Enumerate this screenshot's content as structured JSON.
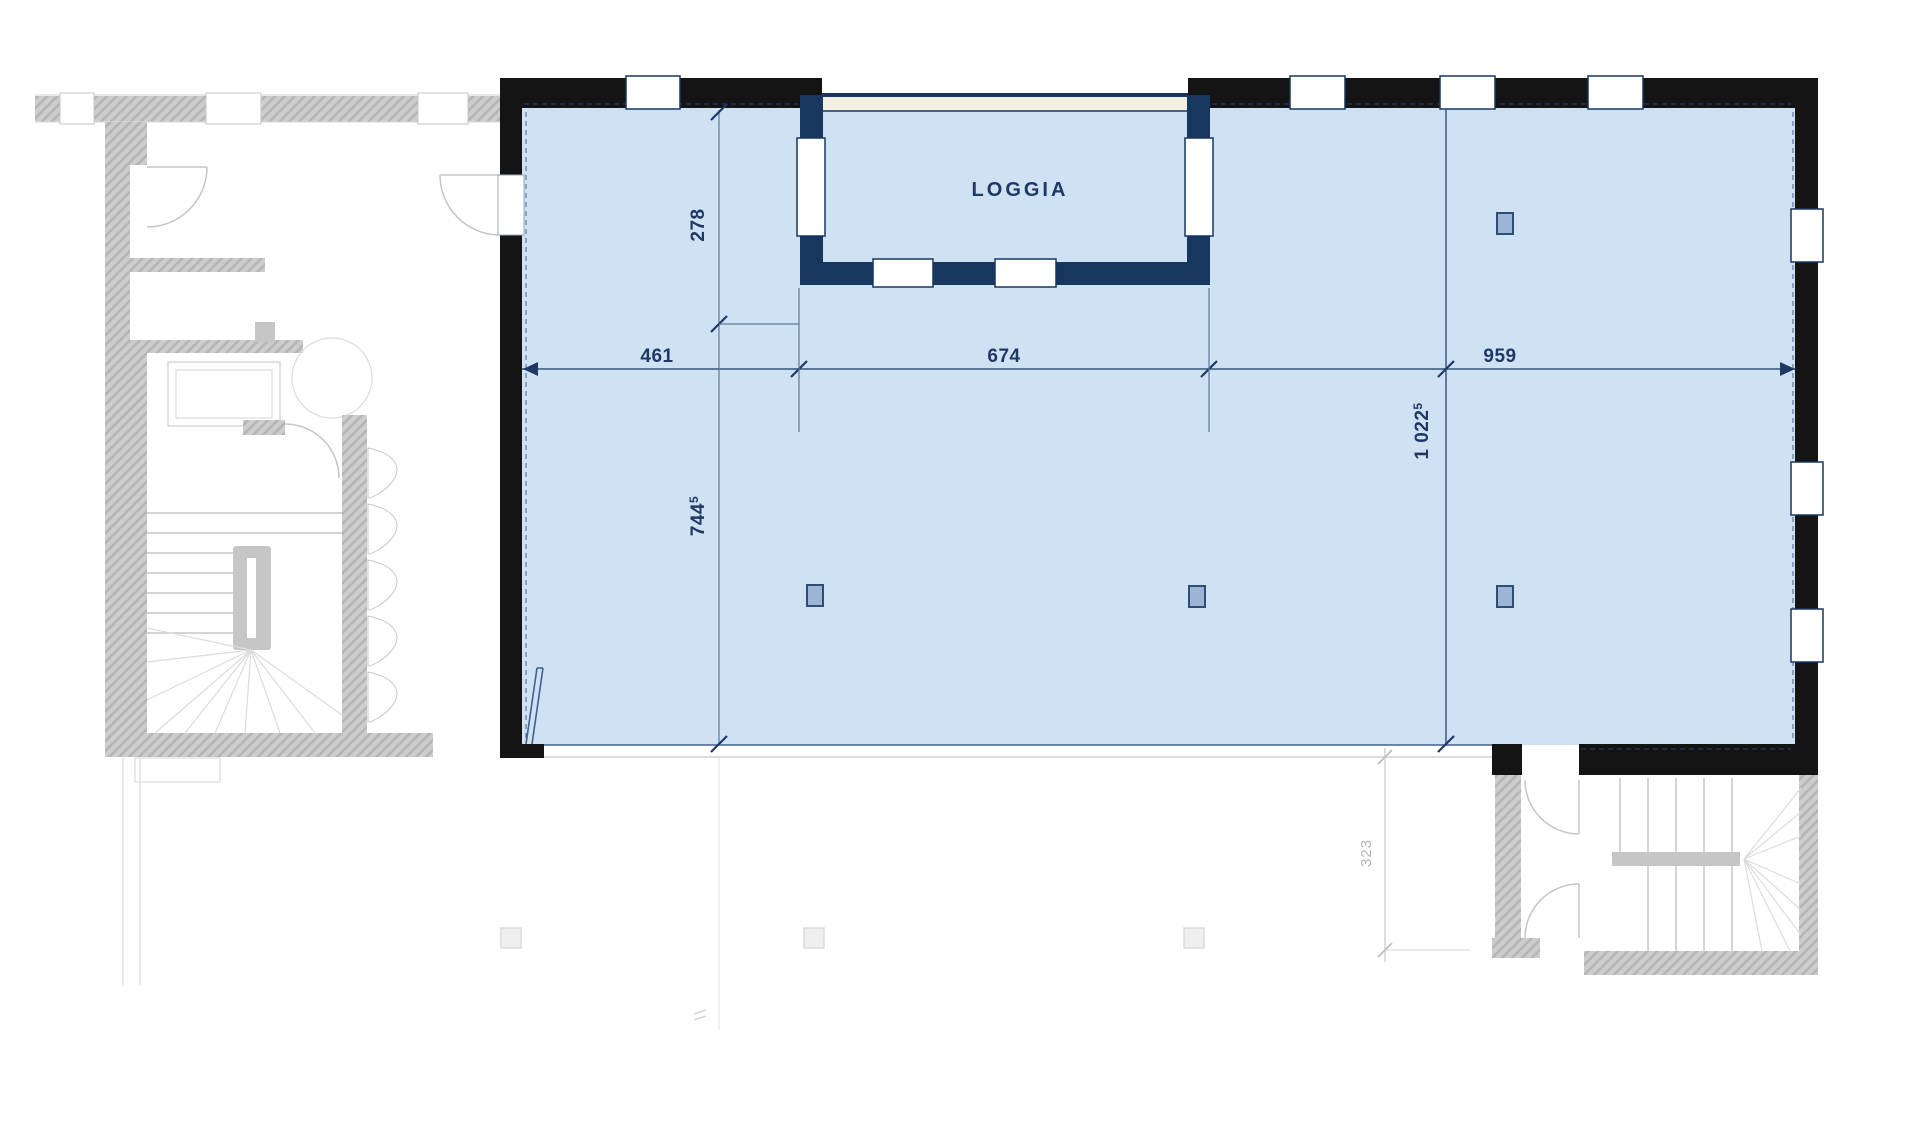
{
  "plan": {
    "room_label": "LOGGIA",
    "dimensions": {
      "d461": "461",
      "d674": "674",
      "d959": "959",
      "d278": "278",
      "d744": "744",
      "d744_sup": "5",
      "d1022": "1 022",
      "d1022_sup": "5",
      "d323": "323"
    }
  },
  "colors": {
    "room-fill": "#cfe2f4",
    "wall-black": "#141414",
    "wall-navy": "#17375e",
    "divider": "#44618a",
    "loggia-band": "#f3efe2",
    "column-fill": "#9db4d4",
    "column-stroke": "#2e4d74",
    "dim-line": "#5d7796",
    "dim-text": "#1f3864",
    "ghost": "#c6c6c6",
    "ghost-light": "#dcdcdc",
    "ghost-text": "#b5b5b5"
  }
}
